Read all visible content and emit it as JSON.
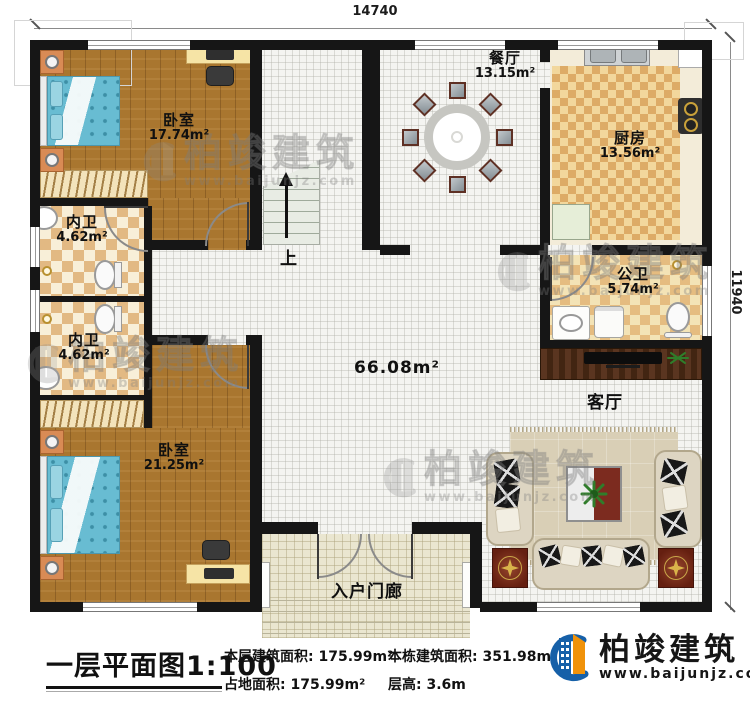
{
  "plan": {
    "dim_top": "14740",
    "dim_right": "11940",
    "stairs_label": "上",
    "hall_area": "66.08m²",
    "rooms": {
      "bedroom1": {
        "name": "卧室",
        "area": "17.74m²"
      },
      "bath1": {
        "name": "内卫",
        "area": "4.62m²"
      },
      "bath2": {
        "name": "内卫",
        "area": "4.62m²"
      },
      "bedroom2": {
        "name": "卧室",
        "area": "21.25m²"
      },
      "dining": {
        "name": "餐厅",
        "area": "13.15m²"
      },
      "kitchen": {
        "name": "厨房",
        "area": "13.56m²"
      },
      "public_bath": {
        "name": "公卫",
        "area": "5.74m²"
      },
      "living": {
        "name": "客厅"
      },
      "porch": {
        "name": "入户门廊"
      }
    }
  },
  "title_block": {
    "title": "一层平面图",
    "scale": "1:100",
    "stats": [
      {
        "label": "本层建筑面积:",
        "value": "175.99m²"
      },
      {
        "label": "占地面积:",
        "value": "175.99m²"
      },
      {
        "label": "本栋建筑面积:",
        "value": "351.98m²"
      },
      {
        "label": "层高:",
        "value": "3.6m"
      }
    ]
  },
  "brand": {
    "name": "柏竣建筑",
    "website": "www.baijunjz.com"
  },
  "watermark": {
    "name": "柏竣建筑",
    "website": "www.baijunjz.com"
  },
  "colors": {
    "accent_blue": "#1660a8",
    "accent_orange": "#f0920a",
    "wall": "#161616"
  }
}
